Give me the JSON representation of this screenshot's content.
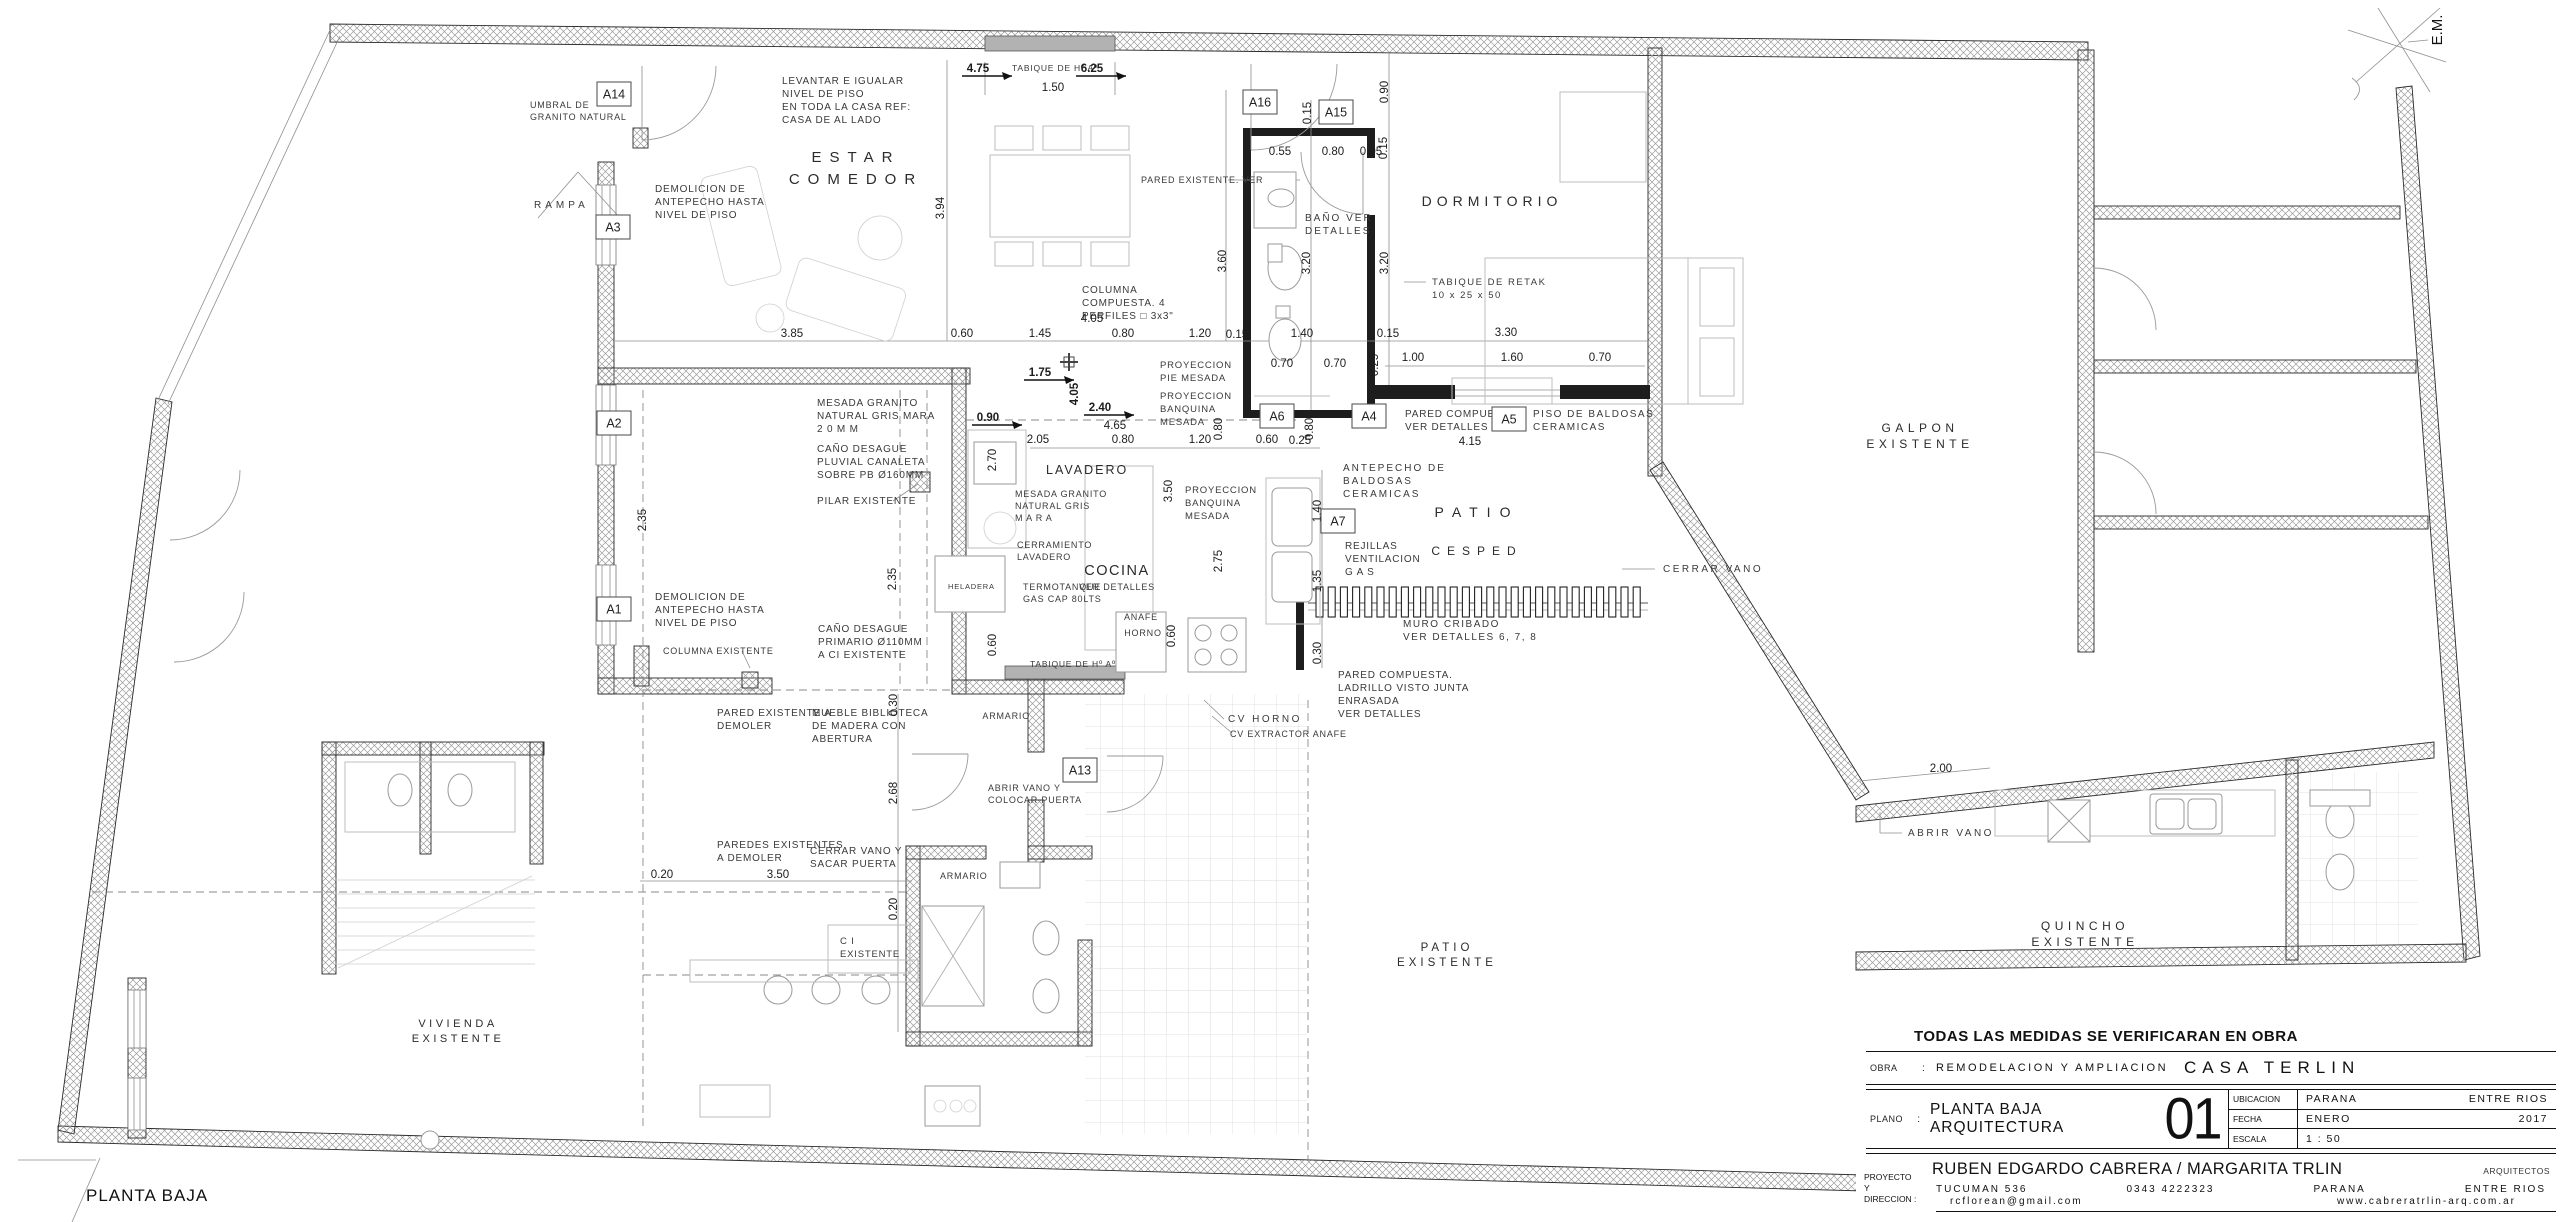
{
  "meta": {
    "plan_label": "PLANTA BAJA",
    "orientation_marker": "E.M."
  },
  "title_block": {
    "note": "TODAS LAS MEDIDAS SE VERIFICARAN EN OBRA",
    "obra_label": "OBRA",
    "colon": ":",
    "obra_value": "REMODELACION Y AMPLIACION",
    "obra_project": "CASA TERLIN",
    "plano_label": "PLANO",
    "plano_value": "PLANTA BAJA ARQUITECTURA",
    "sheet_number": "01",
    "ubicacion_label": "UBICACION",
    "ubicacion_value": "PARANA",
    "ubicacion_region": "ENTRE RIOS",
    "fecha_label": "FECHA",
    "fecha_value": "ENERO",
    "fecha_year": "2017",
    "escala_label": "ESCALA",
    "escala_value": "1 : 50",
    "proyecto_label_1": "PROYECTO",
    "proyecto_label_2": "Y",
    "proyecto_label_3": "DIRECCION :",
    "architects": "RUBEN EDGARDO CABRERA / MARGARITA TRLIN",
    "architects_title": "ARQUITECTOS",
    "address": "TUCUMAN 536",
    "phone": "0343 4222323",
    "city": "PARANA",
    "province": "ENTRE RIOS",
    "email": "rcflorean@gmail.com",
    "website": "www.cabreratrlin-arq.com.ar"
  },
  "rooms": [
    {
      "lines": [
        "ESTAR",
        "COMEDOR"
      ],
      "x": 856,
      "y": 162,
      "fs": 15,
      "ls": 8,
      "lh": 22
    },
    {
      "lines": [
        "DORMITORIO"
      ],
      "x": 1492,
      "y": 206,
      "fs": 14,
      "ls": 5,
      "lh": 18
    },
    {
      "lines": [
        "LAVADERO"
      ],
      "x": 1046,
      "y": 474,
      "fs": 12.5,
      "ls": 2,
      "lh": 16,
      "anchor": "start"
    },
    {
      "lines": [
        "COCINA"
      ],
      "x": 1117,
      "y": 575,
      "fs": 14.5,
      "ls": 1.5,
      "lh": 16
    },
    {
      "lines": [
        "PATIO"
      ],
      "x": 1477,
      "y": 517,
      "fs": 14,
      "ls": 9,
      "lh": 18
    },
    {
      "lines": [
        "CESPED"
      ],
      "x": 1477,
      "y": 555,
      "fs": 12,
      "ls": 7,
      "lh": 16
    },
    {
      "lines": [
        "GALPON",
        "EXISTENTE"
      ],
      "x": 1920,
      "y": 432,
      "fs": 12,
      "ls": 4.5,
      "lh": 16
    },
    {
      "lines": [
        "QUINCHO",
        "EXISTENTE"
      ],
      "x": 2085,
      "y": 930,
      "fs": 12,
      "ls": 4.5,
      "lh": 16
    },
    {
      "lines": [
        "PATIO",
        "EXISTENTE"
      ],
      "x": 1447,
      "y": 951,
      "fs": 11.5,
      "ls": 4,
      "lh": 15
    },
    {
      "lines": [
        "VIVIENDA",
        "EXISTENTE"
      ],
      "x": 458,
      "y": 1027,
      "fs": 11,
      "ls": 3.5,
      "lh": 15
    }
  ],
  "annotations": [
    {
      "x": 782,
      "y": 84,
      "lines": [
        "LEVANTAR E IGUALAR",
        "NIVEL DE PISO",
        "EN TODA LA CASA  REF:",
        "CASA DE AL LADO"
      ]
    },
    {
      "x": 530,
      "y": 108,
      "lines": [
        "UMBRAL DE",
        "GRANITO NATURAL"
      ],
      "fs": 9
    },
    {
      "x": 534,
      "y": 208,
      "lines": [
        "RAMPA"
      ],
      "ls": 4
    },
    {
      "x": 655,
      "y": 192,
      "lines": [
        "DEMOLICION DE",
        "ANTEPECHO HASTA",
        "NIVEL DE PISO"
      ]
    },
    {
      "x": 655,
      "y": 600,
      "lines": [
        "DEMOLICION DE",
        "ANTEPECHO HASTA",
        "NIVEL DE PISO"
      ]
    },
    {
      "x": 663,
      "y": 654,
      "lines": [
        "COLUMNA EXISTENTE"
      ],
      "fs": 9
    },
    {
      "x": 818,
      "y": 632,
      "lines": [
        "CAÑO DESAGUE",
        "PRIMARIO Ø110MM",
        "A CI EXISTENTE"
      ]
    },
    {
      "x": 817,
      "y": 406,
      "lines": [
        "MESADA GRANITO",
        "NATURAL GRIS MARA",
        "2 0 M M"
      ]
    },
    {
      "x": 817,
      "y": 452,
      "lines": [
        "CAÑO DESAGUE",
        "PLUVIAL CANALETA",
        "SOBRE PB Ø160MM"
      ]
    },
    {
      "x": 817,
      "y": 504,
      "lines": [
        "PILAR EXISTENTE"
      ]
    },
    {
      "x": 1015,
      "y": 497,
      "lines": [
        "MESADA GRANITO",
        "NATURAL GRIS",
        "M A R A"
      ],
      "fs": 9
    },
    {
      "x": 1017,
      "y": 548,
      "lines": [
        "CERRAMIENTO",
        "LAVADERO"
      ],
      "fs": 9
    },
    {
      "x": 1023,
      "y": 590,
      "lines": [
        "TERMOTANQUE",
        "GAS CAP 80LTS"
      ],
      "fs": 9
    },
    {
      "x": 1141,
      "y": 620,
      "lines": [
        "ANAFE"
      ],
      "fs": 9,
      "anchor": "middle"
    },
    {
      "x": 1143,
      "y": 636,
      "lines": [
        "HORNO"
      ],
      "fs": 9,
      "anchor": "middle"
    },
    {
      "x": 1030,
      "y": 667,
      "lines": [
        "TABIQUE DE Hº Aº"
      ],
      "fs": 8.5
    },
    {
      "x": 1012,
      "y": 71,
      "lines": [
        "TABIQUE DE Hº Aº"
      ],
      "fs": 8.5
    },
    {
      "x": 1141,
      "y": 183,
      "lines": [
        "PARED EXISTENTE. VER"
      ],
      "fs": 9
    },
    {
      "x": 1082,
      "y": 293,
      "lines": [
        "COLUMNA",
        "COMPUESTA. 4",
        "PERFILES □ 3x3\""
      ]
    },
    {
      "x": 1160,
      "y": 368,
      "lines": [
        "PROYECCION",
        "PIE MESADA"
      ],
      "fs": 9.5
    },
    {
      "x": 1160,
      "y": 399,
      "lines": [
        "PROYECCION",
        "BANQUINA",
        "MESADA"
      ],
      "fs": 9.5
    },
    {
      "x": 1185,
      "y": 493,
      "lines": [
        "PROYECCION",
        "BANQUINA",
        "MESADA"
      ],
      "fs": 9.5
    },
    {
      "x": 1343,
      "y": 471,
      "lines": [
        "ANTEPECHO DE",
        "BALDOSAS",
        "CERAMICAS"
      ],
      "ls": 2
    },
    {
      "x": 1345,
      "y": 549,
      "lines": [
        "REJILLAS",
        "VENTILACION",
        "G A S"
      ]
    },
    {
      "x": 1403,
      "y": 627,
      "lines": [
        "MURO CRIBADO",
        "VER DETALLES 6, 7, 8"
      ],
      "ls": 1.5
    },
    {
      "x": 1338,
      "y": 678,
      "lines": [
        "PARED COMPUESTA.",
        "LADRILLO VISTO JUNTA",
        "ENRASADA",
        "VER DETALLES"
      ]
    },
    {
      "x": 1663,
      "y": 572,
      "lines": [
        "CERRAR VANO"
      ],
      "ls": 2.5
    },
    {
      "x": 1908,
      "y": 836,
      "lines": [
        "ABRIR VANO"
      ],
      "ls": 2.5
    },
    {
      "x": 1405,
      "y": 417,
      "lines": [
        "PARED COMPUESTA.",
        "VER DETALLES"
      ]
    },
    {
      "x": 1533,
      "y": 417,
      "lines": [
        "PISO DE BALDOSAS",
        "CERAMICAS"
      ],
      "ls": 1.5
    },
    {
      "x": 717,
      "y": 716,
      "lines": [
        "PARED EXISTENTE A",
        "DEMOLER"
      ]
    },
    {
      "x": 812,
      "y": 716,
      "lines": [
        "MUEBLE BIBLIOTECA",
        "DE MADERA CON",
        "ABERTURA"
      ]
    },
    {
      "x": 717,
      "y": 848,
      "lines": [
        "PAREDES EXISTENTES",
        "A DEMOLER"
      ]
    },
    {
      "x": 810,
      "y": 854,
      "lines": [
        "CERRAR VANO Y",
        "SACAR PUERTA"
      ]
    },
    {
      "x": 940,
      "y": 879,
      "lines": [
        "ARMARIO"
      ],
      "fs": 9
    },
    {
      "x": 1030,
      "y": 719,
      "lines": [
        "ARMARIO"
      ],
      "fs": 9,
      "anchor": "end"
    },
    {
      "x": 988,
      "y": 791,
      "lines": [
        "ABRIR VANO Y",
        "COLOCAR PUERTA"
      ],
      "fs": 9
    },
    {
      "x": 1228,
      "y": 722,
      "lines": [
        "CV HORNO"
      ],
      "ls": 2.5
    },
    {
      "x": 1230,
      "y": 737,
      "lines": [
        "CV EXTRACTOR  ANAFE"
      ],
      "fs": 9
    },
    {
      "x": 840,
      "y": 944,
      "lines": [
        "C       I",
        "EXISTENTE"
      ],
      "fs": 9.5
    },
    {
      "x": 1305,
      "y": 221,
      "lines": [
        "BAÑO VER",
        "DETALLES"
      ],
      "ls": 2
    },
    {
      "x": 948,
      "y": 589,
      "lines": [
        "HELADERA"
      ],
      "fs": 7.5
    },
    {
      "x": 1432,
      "y": 285,
      "lines": [
        "TABIQUE DE RETAK",
        "10 x 25 x 50"
      ],
      "fs": 9.5,
      "ls": 1.5
    },
    {
      "x": 1117,
      "y": 590,
      "lines": [
        "VER DETALLES"
      ],
      "fs": 9,
      "anchor": "middle"
    }
  ],
  "dimensions": [
    {
      "t": "4.75",
      "x": 978,
      "y": 72,
      "b": 1,
      "ar": 1
    },
    {
      "t": "6.25",
      "x": 1092,
      "y": 72,
      "b": 1,
      "ar": 1
    },
    {
      "t": "1.50",
      "x": 1053,
      "y": 91
    },
    {
      "t": "0.90",
      "x": 1388,
      "y": 92,
      "r": 1
    },
    {
      "t": "0.15",
      "x": 1311,
      "y": 113,
      "r": 1
    },
    {
      "t": "0.55",
      "x": 1280,
      "y": 155
    },
    {
      "t": "0.80",
      "x": 1333,
      "y": 155
    },
    {
      "t": "0.05",
      "x": 1371,
      "y": 155
    },
    {
      "t": "0.15",
      "x": 1387,
      "y": 148,
      "r": 1
    },
    {
      "t": "3.60",
      "x": 1226,
      "y": 261,
      "r": 1
    },
    {
      "t": "3.94",
      "x": 944,
      "y": 208,
      "r": 1
    },
    {
      "t": "3.20",
      "x": 1310,
      "y": 263,
      "r": 1
    },
    {
      "t": "3.20",
      "x": 1388,
      "y": 263,
      "r": 1
    },
    {
      "t": "3.85",
      "x": 792,
      "y": 337
    },
    {
      "t": "0.60",
      "x": 962,
      "y": 337
    },
    {
      "t": "1.45",
      "x": 1040,
      "y": 337
    },
    {
      "t": "0.80",
      "x": 1123,
      "y": 337
    },
    {
      "t": "1.20",
      "x": 1200,
      "y": 337
    },
    {
      "t": "0.15",
      "x": 1237,
      "y": 338
    },
    {
      "t": "1.40",
      "x": 1302,
      "y": 337
    },
    {
      "t": "0.15",
      "x": 1388,
      "y": 337
    },
    {
      "t": "3.30",
      "x": 1506,
      "y": 336
    },
    {
      "t": "0.25",
      "x": 1378,
      "y": 365,
      "r": 1
    },
    {
      "t": "1.00",
      "x": 1413,
      "y": 361
    },
    {
      "t": "1.60",
      "x": 1512,
      "y": 361
    },
    {
      "t": "0.70",
      "x": 1600,
      "y": 361
    },
    {
      "t": "0.70",
      "x": 1282,
      "y": 367
    },
    {
      "t": "0.70",
      "x": 1335,
      "y": 367
    },
    {
      "t": "4.05",
      "x": 1092,
      "y": 322
    },
    {
      "t": "1.75",
      "x": 1040,
      "y": 376,
      "b": 1,
      "ar": 1
    },
    {
      "t": "4.05",
      "x": 1078,
      "y": 394,
      "r": 1,
      "b": 1
    },
    {
      "t": "2.40",
      "x": 1100,
      "y": 411,
      "b": 1,
      "ar": 1
    },
    {
      "t": "4.65",
      "x": 1115,
      "y": 429
    },
    {
      "t": "2.05",
      "x": 1038,
      "y": 443
    },
    {
      "t": "0.80",
      "x": 1123,
      "y": 443
    },
    {
      "t": "1.20",
      "x": 1200,
      "y": 443
    },
    {
      "t": "0.60",
      "x": 1267,
      "y": 443
    },
    {
      "t": "0.25",
      "x": 1300,
      "y": 444
    },
    {
      "t": "0.80",
      "x": 1222,
      "y": 429,
      "r": 1
    },
    {
      "t": "0.80",
      "x": 1313,
      "y": 429,
      "r": 1
    },
    {
      "t": "0.90",
      "x": 988,
      "y": 421,
      "b": 1,
      "ar": 1
    },
    {
      "t": "2.70",
      "x": 996,
      "y": 460,
      "r": 1
    },
    {
      "t": "2.35",
      "x": 896,
      "y": 579,
      "r": 1
    },
    {
      "t": "2.35",
      "x": 646,
      "y": 520,
      "r": 1
    },
    {
      "t": "3.50",
      "x": 1172,
      "y": 491,
      "r": 1
    },
    {
      "t": "2.75",
      "x": 1222,
      "y": 561,
      "r": 1
    },
    {
      "t": "0.60",
      "x": 996,
      "y": 645,
      "r": 1
    },
    {
      "t": "0.60",
      "x": 1175,
      "y": 636,
      "r": 1
    },
    {
      "t": "1.40",
      "x": 1321,
      "y": 511,
      "r": 1
    },
    {
      "t": "1.35",
      "x": 1321,
      "y": 581,
      "r": 1
    },
    {
      "t": "0.30",
      "x": 1321,
      "y": 653,
      "r": 1
    },
    {
      "t": "4.15",
      "x": 1470,
      "y": 445
    },
    {
      "t": "0.20",
      "x": 662,
      "y": 878
    },
    {
      "t": "3.50",
      "x": 778,
      "y": 878
    },
    {
      "t": "0.30",
      "x": 897,
      "y": 705,
      "r": 1
    },
    {
      "t": "2.68",
      "x": 897,
      "y": 793,
      "r": 1
    },
    {
      "t": "0.20",
      "x": 897,
      "y": 909,
      "r": 1
    },
    {
      "t": "2.00",
      "x": 1941,
      "y": 772
    }
  ],
  "ref_tags": [
    {
      "label": "A14",
      "x": 614,
      "y": 94
    },
    {
      "label": "A3",
      "x": 613,
      "y": 227
    },
    {
      "label": "A2",
      "x": 614,
      "y": 423
    },
    {
      "label": "A1",
      "x": 614,
      "y": 609
    },
    {
      "label": "A16",
      "x": 1260,
      "y": 102
    },
    {
      "label": "A15",
      "x": 1336,
      "y": 112
    },
    {
      "label": "A13",
      "x": 1080,
      "y": 770
    },
    {
      "label": "A6",
      "x": 1277,
      "y": 416
    },
    {
      "label": "A4",
      "x": 1369,
      "y": 416
    },
    {
      "label": "A5",
      "x": 1509,
      "y": 419
    },
    {
      "label": "A7",
      "x": 1338,
      "y": 521
    }
  ]
}
